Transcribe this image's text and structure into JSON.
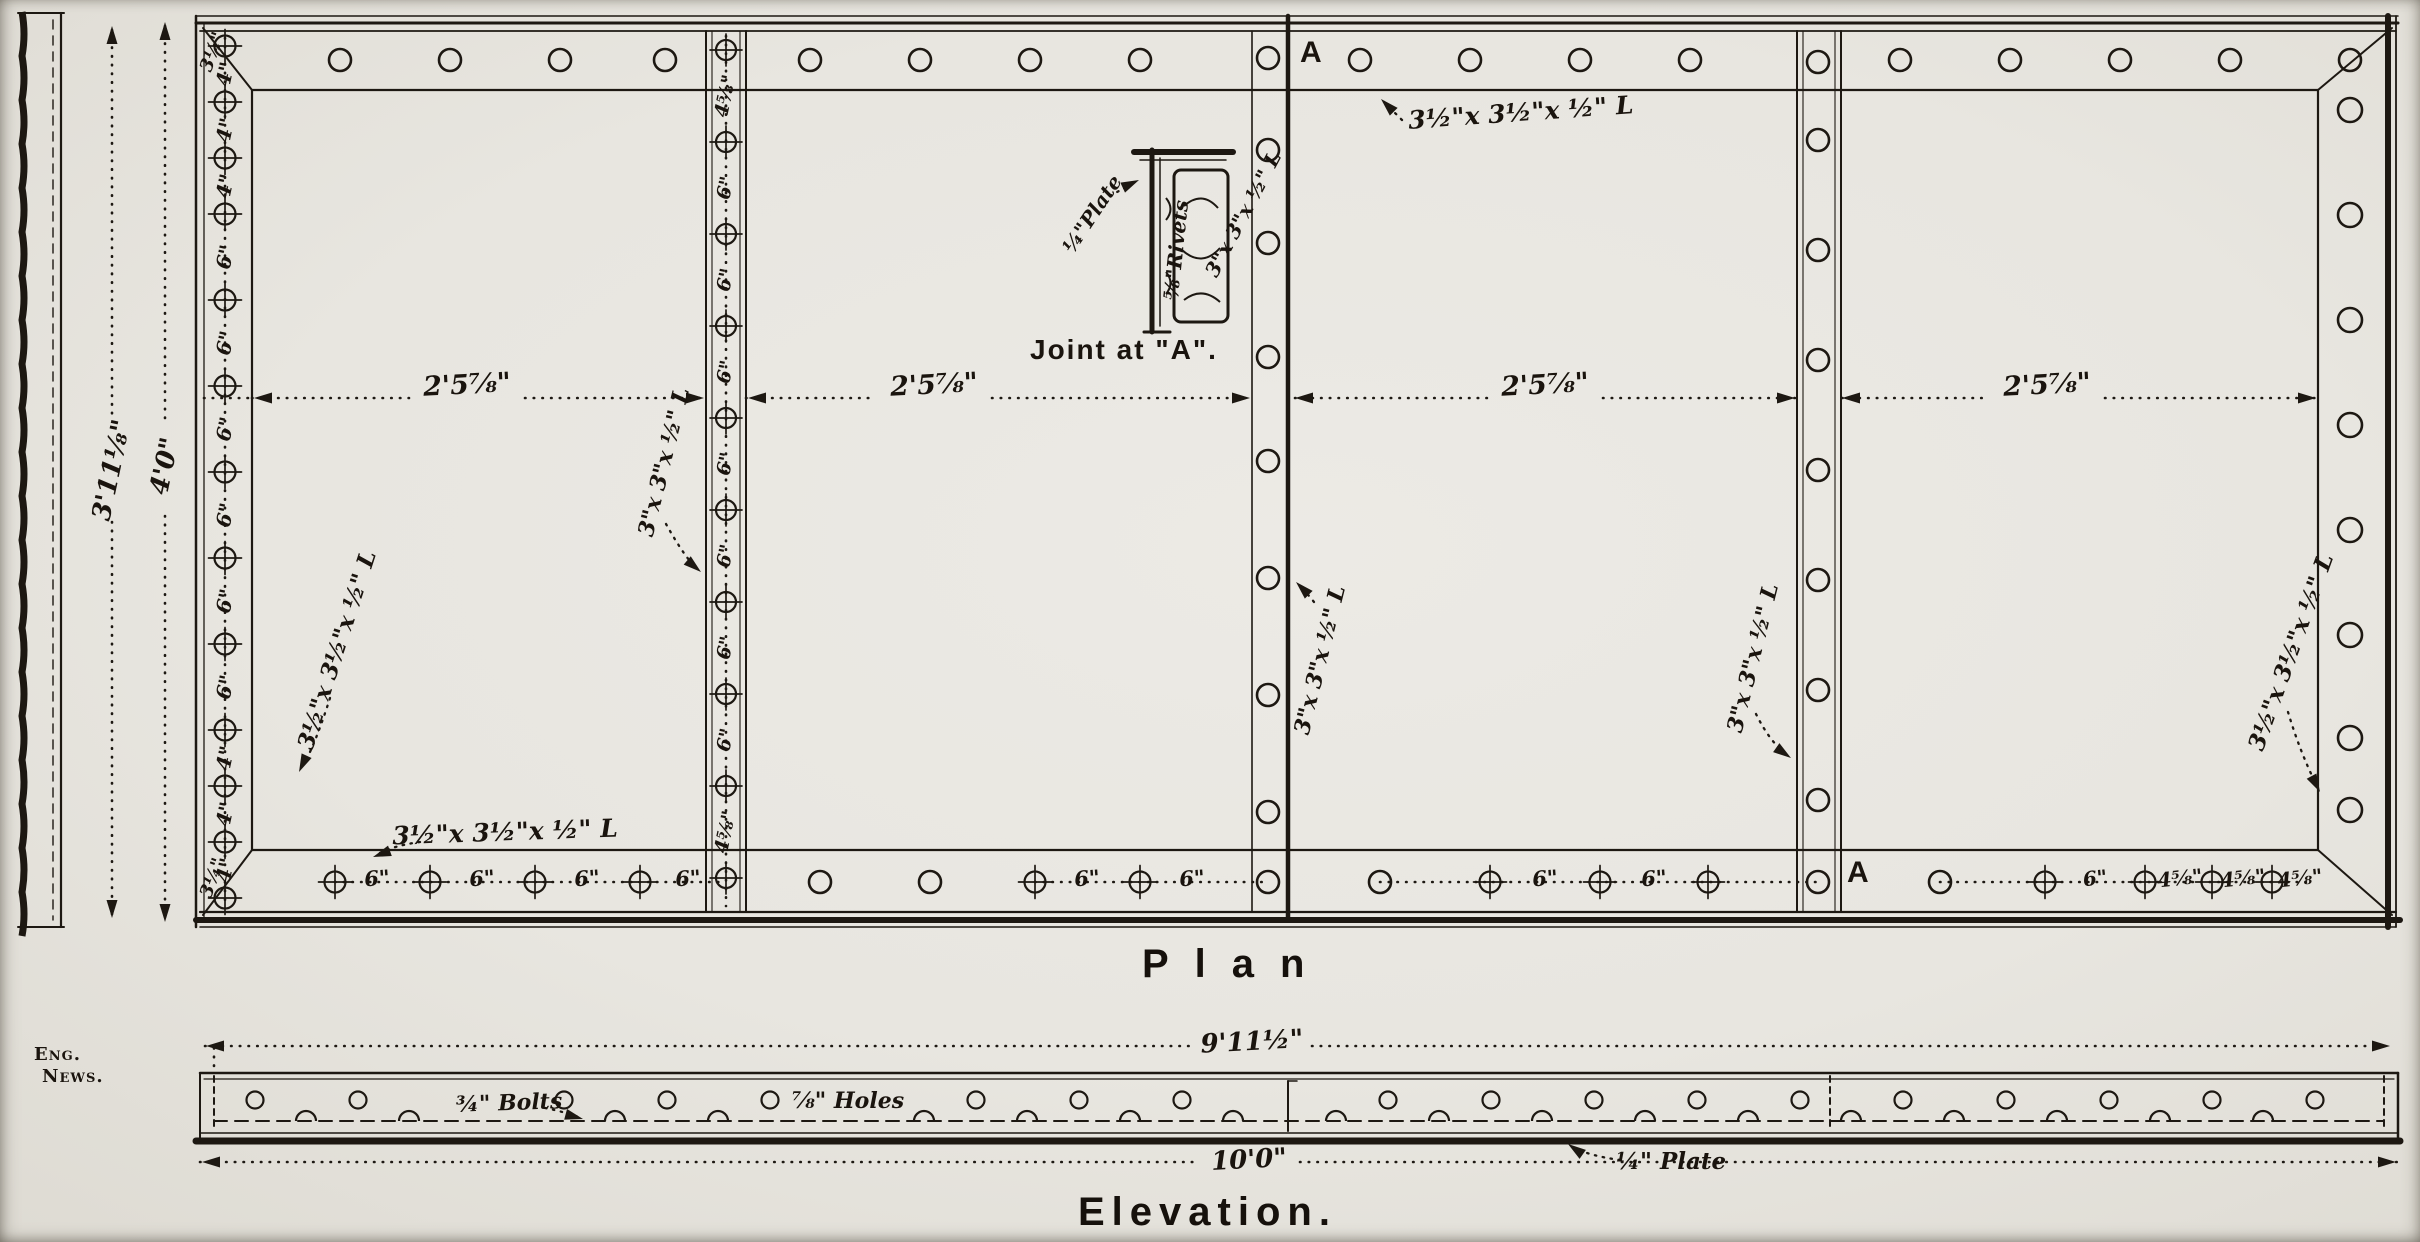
{
  "credit": {
    "line1": "Eng.",
    "line2": "News."
  },
  "plan": {
    "title": "Plan",
    "section_marker_top": "A",
    "section_marker_bottom": "A",
    "panel_width_labels": [
      "2'5⅞\"",
      "2'5⅞\"",
      "2'5⅞\"",
      "2'5⅞\""
    ],
    "plate_height_label": "3'11⅛\"",
    "overall_height_label": "4'0\"",
    "edge_angle_top": "3½\"x 3½\"x ½\" L",
    "edge_angle_bottom": "3½\"x 3½\"x ½\" L",
    "edge_angle_left": "3½\"x 3½\"x ½\" L",
    "edge_angle_right": "3½\"x 3½\"x ½\" L",
    "stiffener_angle_1": "3\"x 3\"x ½\" L",
    "joint_angle": "3\"x 3\"x ½\" L",
    "stiffener_angle_2": "3\"x 3\"x ½\" L",
    "left_corner_spacing_top": "3¼\"",
    "left_corner_spacing_bottom": "3¼\"",
    "left_rivet_spacings": [
      "4\"",
      "4\"",
      "4\"",
      "6\"",
      "6\"",
      "6\"",
      "6\"",
      "6\"",
      "6\"",
      "4\"",
      "4\"",
      "4\""
    ],
    "stiffener1_spacings": [
      "4⅝\"",
      "6\"",
      "6\"",
      "6\"",
      "6\"",
      "6\"",
      "6\"",
      "6\"",
      "4⅝\""
    ],
    "bottom_spacings_panel1": [
      "6\"",
      "6\"",
      "6\"",
      "6\""
    ],
    "bottom_spacings_panel2": [
      "6\"",
      "6\""
    ],
    "bottom_spacings_panel3": [
      "6\"",
      "6\""
    ],
    "bottom_spacings_panel4": [
      "6\"",
      "4⅝\"",
      "4⅝\"",
      "4⅝\""
    ]
  },
  "joint_detail": {
    "caption": "Joint at \"A\".",
    "plate_label": "¼\"Plate",
    "rivets_label": "⅝\"Rivets",
    "angle_label": "3\"x 3\"x ½\" L"
  },
  "elevation": {
    "title": "Elevation.",
    "top_dimension": "9'11½\"",
    "bottom_dimension": "10'0\"",
    "bolts_label": "¾\" Bolts",
    "holes_label": "⅞\" Holes",
    "plate_label": "¼\" Plate"
  }
}
